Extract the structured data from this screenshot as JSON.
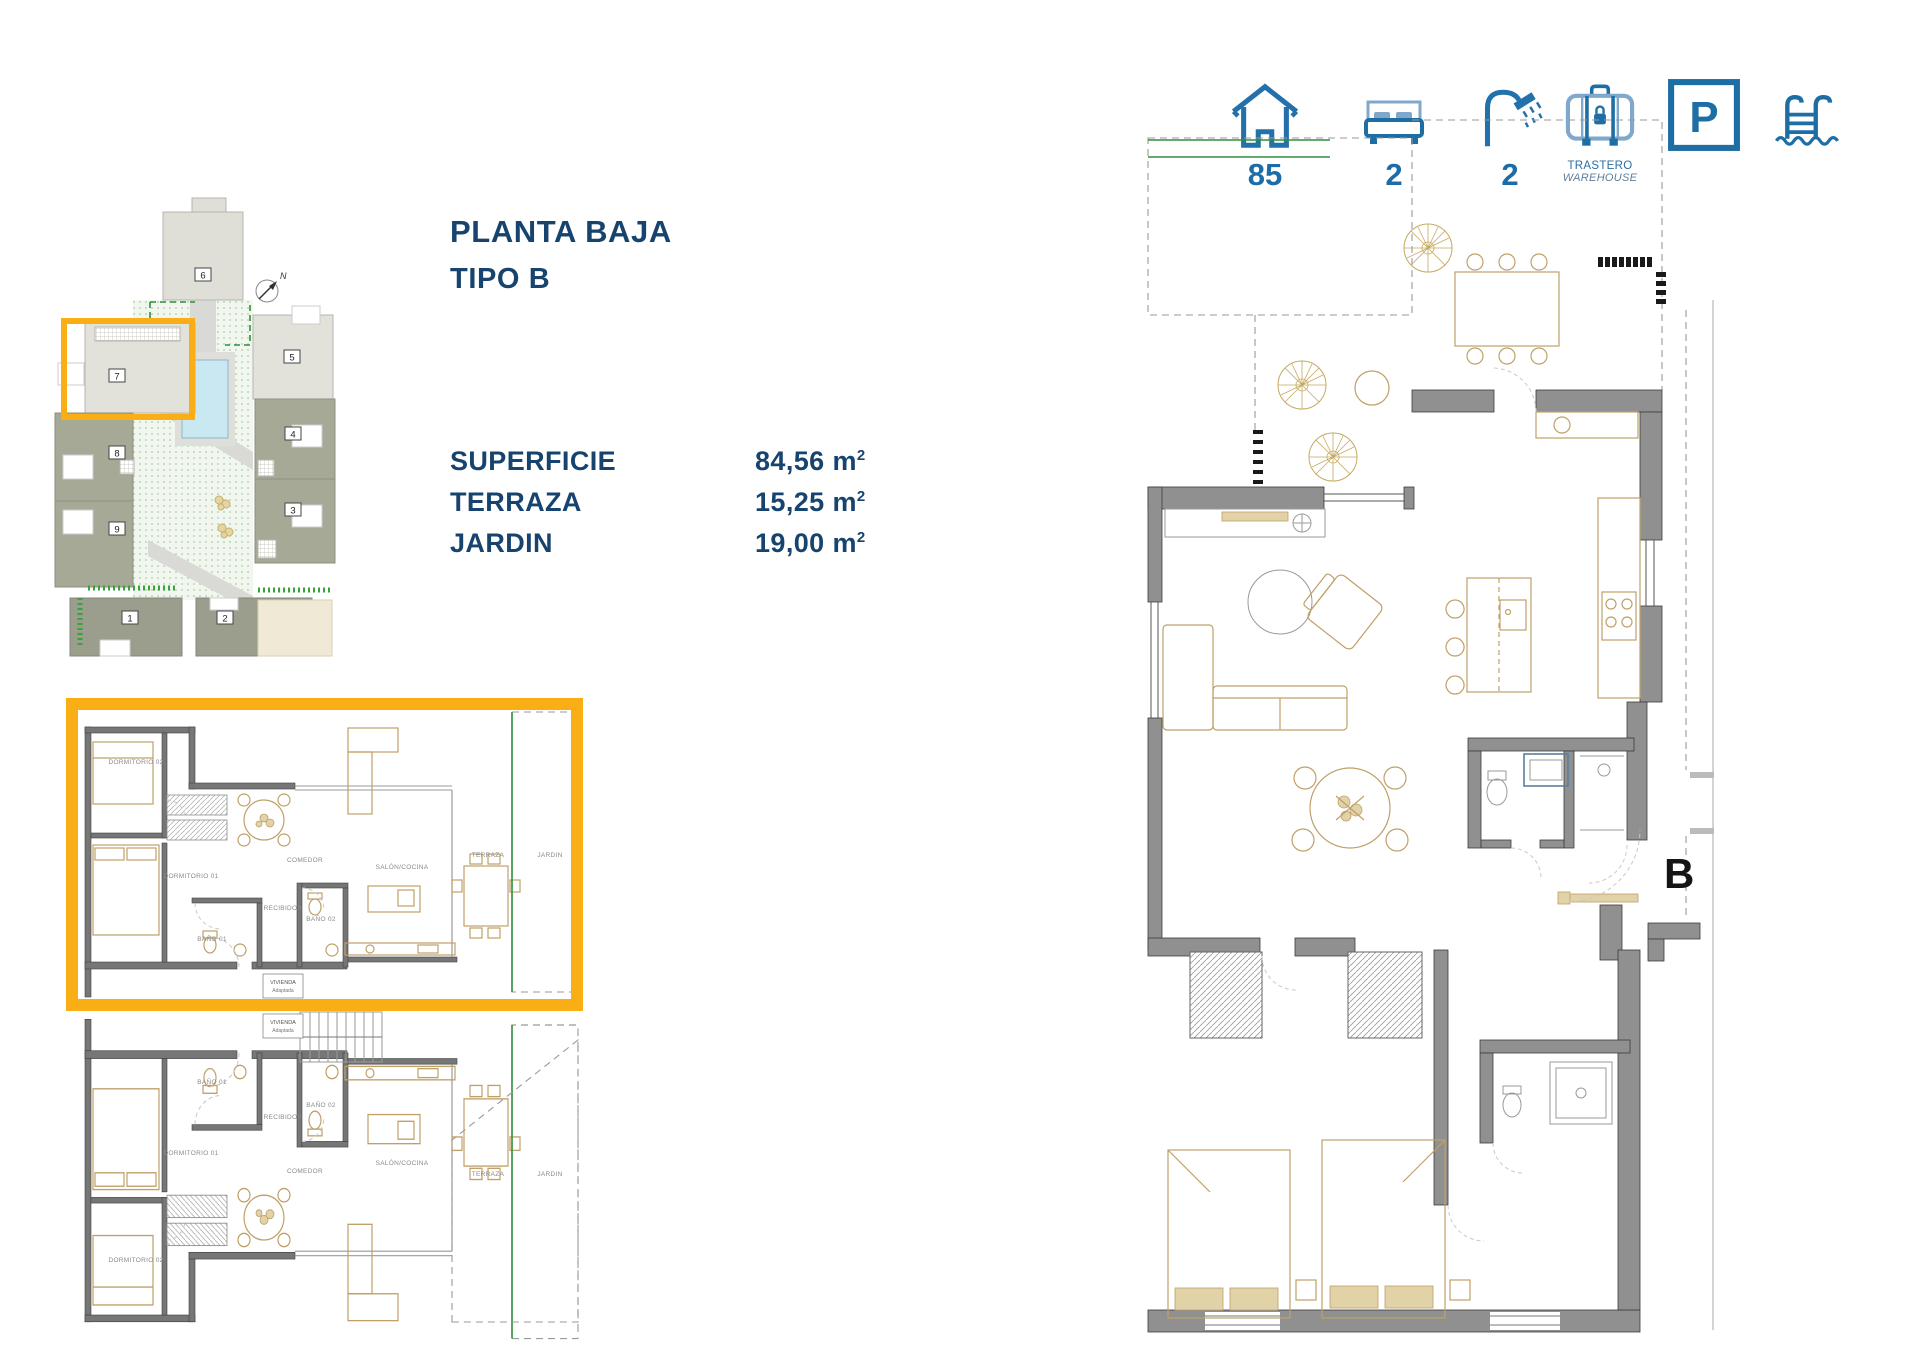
{
  "title": {
    "line1": "PLANTA BAJA",
    "line2": "TIPO B"
  },
  "specs": {
    "rows": [
      {
        "label": "SUPERFICIE",
        "value": "84,56 m",
        "sup": "2"
      },
      {
        "label": "TERRAZA",
        "value": "15,25 m",
        "sup": "2"
      },
      {
        "label": "JARDIN",
        "value": "19,00 m",
        "sup": "2"
      }
    ]
  },
  "stats": {
    "surface": {
      "value": "85"
    },
    "bedrooms": {
      "value": "2"
    },
    "bathrooms": {
      "value": "2"
    },
    "storage": {
      "line1": "TRASTERO",
      "line2": "WAREHOUSE"
    },
    "parking": {
      "letter": "P"
    }
  },
  "site_plan": {
    "compass_label": "N",
    "numbers": [
      "6",
      "5",
      "7",
      "8",
      "4",
      "9",
      "3",
      "1",
      "2"
    ],
    "highlighted_unit": "7"
  },
  "unit_plan": {
    "plan_letter": "B",
    "rooms": {
      "dormitorio2": "DORMITORIO 02",
      "dormitorio1": "DORMITORIO 01",
      "bano1": "BAÑO 01",
      "bano2": "BAÑO 02",
      "recibidor": "RECIBIDOR",
      "comedor": "COMEDOR",
      "salon_cocina": "SALÓN/COCINA",
      "terraza": "TERRAZA",
      "jardin": "JARDIN"
    },
    "tags": {
      "line1": "VIVIENDA",
      "line2": "Adaptada"
    }
  },
  "colors": {
    "navy": "#17446F",
    "icon_blue": "#1E6EA6",
    "icon_blue_light": "#7FA8CC",
    "accent_orange": "#F9AE15",
    "wall_gray": "#909090",
    "furniture_tan": "#BFA068",
    "garden_green": "#3E9E4E"
  }
}
